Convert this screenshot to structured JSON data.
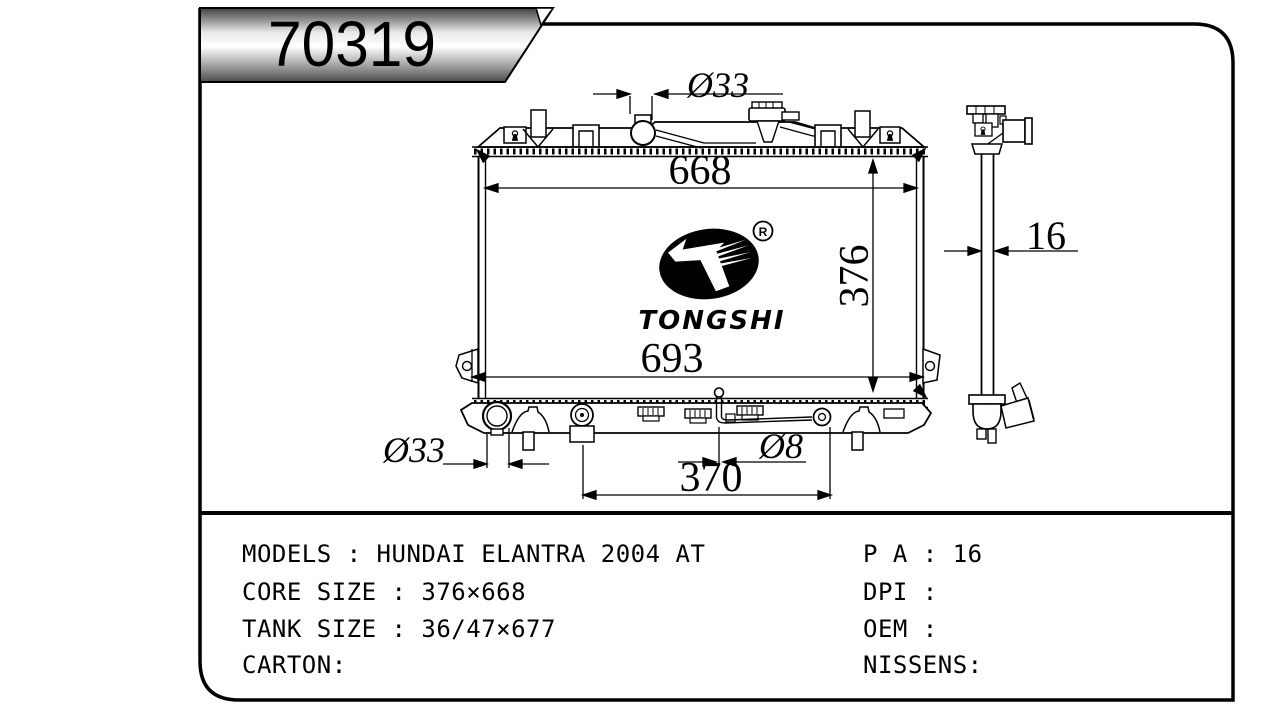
{
  "part_number": "70319",
  "logo": {
    "brand": "TONGSHI",
    "registered_mark": "R"
  },
  "dimensions": {
    "top_inlet_diameter": "Ø33",
    "core_width": "668",
    "core_height": "376",
    "overall_width": "693",
    "bottom_outlet_diameter": "Ø33",
    "drain_pipe_diameter": "Ø8",
    "bottom_fitting_span": "370",
    "core_thickness": "16"
  },
  "specs": {
    "models": "MODELS : HUNDAI ELANTRA 2004 AT",
    "core_size": "CORE SIZE : 376×668",
    "tank_size": "TANK SIZE : 36/47×677",
    "carton": "CARTON:",
    "pa": "P A : 16",
    "dpi": "DPI :",
    "oem": "OEM :",
    "nissens": "NISSENS:"
  }
}
